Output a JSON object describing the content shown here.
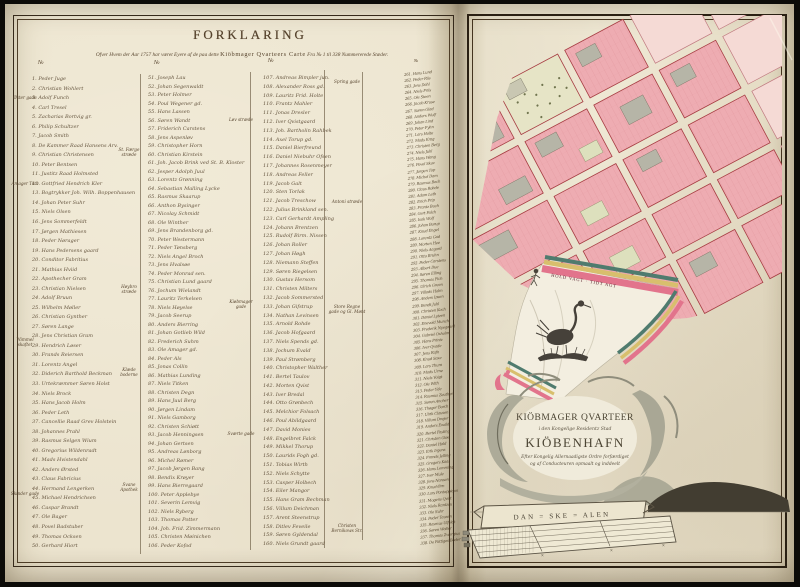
{
  "page_left": {
    "title": "FORKLARING",
    "subtitle_pre": "Ofver Hvem der Aar 1757 har været Eyere af de paa dette ",
    "subtitle_caps": "Kiöbmager Qvarteers Carte",
    "subtitle_post": " Fra № 1 til 338 Nummererede Stæder.",
    "number_header": "№",
    "margin_labels": {
      "left": [
        "Øster gade",
        "Amager Torv",
        "Wimmel skaftet",
        "Skinder gade"
      ],
      "lane1": [
        "St. Færge stræde",
        "Høybro stræde",
        "Klæde boderne",
        "Svane Apothek"
      ],
      "lane2": [
        "Løv stræde",
        "Kiøbmager gade",
        "Sværte gade"
      ],
      "lane3": [
        "Spring gade",
        "Antoni stræde",
        "Store Regne gade og Gl. Mønt",
        "Christen Bernikows Str."
      ]
    },
    "columns": [
      [
        "1. Peder Juge",
        "2. Christian Wohlert",
        "3. Adolf Funch",
        "4. Carl Tresel",
        "5. Zacharias Bortvig gr.",
        "6. Philip Schultzer",
        "7. Jacob Smith",
        "8. De Kammer Raad Hansens Arv.",
        "9. Christian Christensen",
        "10. Peter Bentsen",
        "11. Justitz Raad Holmsted",
        "12. Gottfried Hendrich Kler",
        "13. Bogtrykker Joh. Wilh. Boppenhausen",
        "14. Johan Peter Suhr",
        "15. Niels Olsen",
        "16. Jens Sommerfeldt",
        "17. Jørgen Mathiesen",
        "18. Peder Nørager",
        "19. Hans Pedersens gaard",
        "20. Conditor Fabritius",
        "21. Mathias Hviid",
        "22. Apothecher Gram",
        "23. Christian Nielsen",
        "24. Adolf Bruun",
        "25. Wilhelm Møller",
        "26. Christian Gynther",
        "27. Søren Lange",
        "28. Jens Christian Gram",
        "29. Hendrich Løser",
        "30. Frands Reiersen",
        "31. Lorentz Angel",
        "32. Diderich Barthold Beckman",
        "33. Urtekræmmer Søren Holst",
        "34. Niels Brock",
        "35. Hans Jacob Holm",
        "36. Peder Leth",
        "37. Cancellie Raad Grev Holstein",
        "38. Johannes Prahl",
        "39. Rasmus Selgen Wium",
        "40. Gregorius Wildenradt",
        "41. Mads Hvistendahl",
        "42. Anders Ørsted",
        "43. Claus Fabricius",
        "44. Hermand Lengerken",
        "45. Michael Hendrichsen",
        "46. Caspar Brandt",
        "47. Ole Bager",
        "48. Povel Badstuber",
        "49. Thomas Ocksen",
        "50. Gerhard Hiort"
      ],
      [
        "51. Joseph Lau",
        "52. Johan Segenwaldt",
        "53. Peter Holmer",
        "54. Poul Wegener gd.",
        "55. Hans Lassen",
        "56. Søren Wandt",
        "57. Friderich Carstens",
        "58. Jens Aspenløv",
        "59. Christopher Horn",
        "60. Christian Kirstein",
        "61. Joh. Jacob Brink ved St. B. Kloster",
        "62. Jesper Adolph Juul",
        "63. Lorentz Grønning",
        "64. Sebastian Malling Lycke",
        "65. Rasmus Skaarup",
        "66. Anthon Bysinger",
        "67. Nicolay Schmidt",
        "68. Ole Winther",
        "69. Jens Brandenborg gd.",
        "70. Peter Westermann",
        "71. Peder Tønsberg",
        "72. Niels Angel Broch",
        "73. Jens Hvalsøe",
        "74. Peder Monrad sen.",
        "75. Christian Lund gaard",
        "76. Jochum Wielandt",
        "77. Lauritz Terkelsen",
        "78. Niels Høyelse",
        "79. Jacob Seerup",
        "80. Anders Bierring",
        "81. Johan Gotlieb Wild",
        "82. Frederich Suhm",
        "83. Ole Amager gd.",
        "84. Peder Als",
        "85. Jonas Collin",
        "86. Mathias Lunding",
        "87. Niels Titken",
        "88. Christen Degn",
        "89. Hans Juul Berg",
        "90. Jørgen Lindam",
        "91. Niels Gamborg",
        "92. Christen Schiøtt",
        "93. Jacob Henningsen",
        "94. Johan Gertsen",
        "95. Andreas Lønborg",
        "96. Michel Rømer",
        "97. Jacob Jørgen Bang",
        "98. Bendix Krøyer",
        "99. Hans Bierregaard",
        "100. Peter Applebye",
        "101. Severin Lemvig",
        "102. Niels Ryberg",
        "103. Thomas Potter",
        "104. Joh. Frid. Zimmermann",
        "105. Christen Møinichen",
        "106. Peder Kofod"
      ],
      [
        "107. Andreas Bimpler jun.",
        "108. Alexander Ross gd.",
        "109. Lauritz Frid. Holte",
        "110. Frantz Mahler",
        "111. Jonas Dresler",
        "112. Iver Qvistgaard",
        "113. Joh. Bartholin Rahbek",
        "114. Axel Torup gd.",
        "115. Daniel Bierfreund",
        "116. Daniel Niebuhr Ofsen",
        "117. Johannes Rosenmeyer",
        "118. Andreas Feller",
        "119. Jacob Galt",
        "120. Sten Torlak",
        "121. Jacob Treschow",
        "122. Julius Brinkland sen.",
        "123. Carl Gerhardt Ampling",
        "124. Johann Brentzen",
        "125. Rudolf Birm. Nissen",
        "126. Johan Roller",
        "127. Johan Høgh",
        "128. Niemann Steffen",
        "129. Søren Riegelsen",
        "130. Gustav Hersom",
        "131. Christen Milters",
        "132. Jacob Sommersted",
        "133. Johan Gifstrup",
        "134. Nathan Levinsen",
        "135. Arnold Rohde",
        "136. Jacob Hofgaard",
        "137. Niels Spends gd.",
        "138. Jochum Evald",
        "139. Paul Strømberg",
        "140. Christopher Walther",
        "141. Bertel Taulov",
        "142. Morten Qvist",
        "143. Iver Bredal",
        "144. Otto Grønbech",
        "145. Melchior Folsach",
        "146. Poul Abildgaard",
        "147. David Monies",
        "148. Engelbret Falck",
        "149. Mikkel Thorup",
        "150. Laurids Fogh gd.",
        "151. Tobias Wirth",
        "152. Niels Schytte",
        "153. Casper Holbech",
        "154. Eiler Mangor",
        "155. Hans Gram Bechman",
        "156. Villum Deichman",
        "157. Arent Steenstrup",
        "158. Ditlev Feveile",
        "159. Søren Gyldendal",
        "160. Niels Grundt gaard"
      ],
      [
        "261. Hans Lund",
        "262. Peder Riis",
        "263. Jens Dahl",
        "264. Niels Friis",
        "265. Ole Steen",
        "266. Jacob Kruse",
        "267. Søren Glad",
        "268. Anders Wulf",
        "269. Johan Lind",
        "270. Peter Fyhn",
        "271. Lars Holte",
        "272. Mads Krag",
        "273. Christen Berg",
        "274. Niels Juhl",
        "275. Hans Wang",
        "276. Povel Skov",
        "277. Jørgen Top",
        "278. Michel Dam",
        "279. Rasmus Bech",
        "280. Claus Rohde",
        "281. Adam Leth",
        "282. Erich Prip",
        "283. Frantz Buch",
        "284. Gert Falch",
        "285. Isak Wolf",
        "286. Johan Borup",
        "287. Knud Engel",
        "288. Lorentz Gad",
        "289. Morten Hee",
        "290. Niels Aagard",
        "291. Otto Bruhn",
        "292. Peder Carstens",
        "293. Albert Due",
        "294. Søren Elling",
        "295. Thomas Fich",
        "296. Ulrich Green",
        "297. Villads Holm",
        "298. Anders Ipsen",
        "299. Bendt Juhl",
        "300. Christen Koch",
        "301. Daniel Lytzen",
        "302. Enevold Munch",
        "303. Frederik Nyegaard",
        "304. Gabriel Oxholm",
        "305. Hans Printz",
        "306. Iver Qvade",
        "307. Jens Rafn",
        "308. Knud Saxe",
        "309. Lars Thura",
        "310. Mads Urne",
        "311. Niels Voigt",
        "312. Ole With",
        "313. Peder Yde",
        "314. Rasmus Zeuthen",
        "315. Søren Ancher",
        "316. Thøger Borch",
        "317. Ulrik Clausen",
        "318. Villum Drejer",
        "319. Anders Ewald",
        "320. Bertel Fasting",
        "321. Christen Giøe",
        "322. Daniel Hald",
        "323. Erik Irgens",
        "324. Frands Jelling",
        "325. Gregers Kaas",
        "326. Hans Lemming",
        "327. Iver Mule",
        "328. Jens Nansen",
        "329. Knud Ørn",
        "330. Lars Pontoppidan",
        "331. Mogens Qvist",
        "332. Niels Rantzau",
        "333. Ole Suhr",
        "334. Peder Tausen",
        "335. Rasmus Ulfeldt",
        "336. Søren Walter",
        "337. Thomas Zwergius",
        "338. De Fattiges Boder"
      ]
    ]
  },
  "page_right": {
    "flag_motto": "HOLD VAGT · TIDT AGT",
    "cartouche": {
      "line1": "KIÖBMAGER QVARTEER",
      "line2": "i den Kongelige Residentz Stad",
      "line3": "KIÖBENHAFN",
      "line4": "Efter Kongelig Allernaadigste Ordre forfærdiget",
      "line5": "og af Conducteuren opmaalt og inddeelt"
    },
    "scale_label": "DAN = SKE = ALEN",
    "colors": {
      "block_pink": "#eeacb2",
      "block_pale": "#f5dad5",
      "building_gray": "#b6b5a7",
      "garden_green": "#e6e4c6",
      "stripe_pink": "#e2748c",
      "stripe_yellow": "#d8bf6d",
      "stripe_teal": "#4f7b6e",
      "ink_brown": "#4f3e29"
    }
  }
}
